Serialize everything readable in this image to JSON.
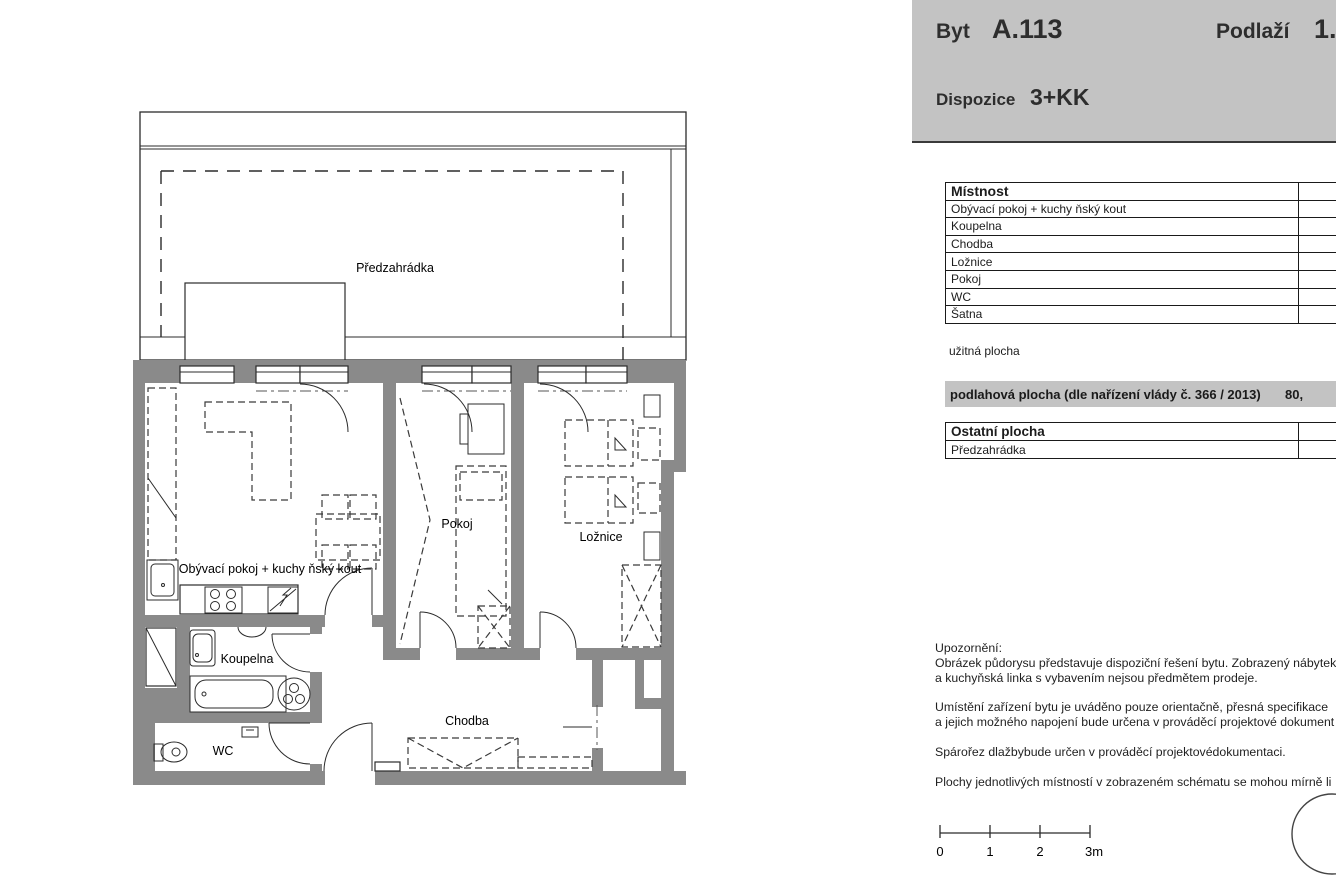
{
  "header": {
    "unit_label": "Byt",
    "unit_value": "A.113",
    "floor_label": "Podlaží",
    "floor_value": "1.",
    "layout_label": "Dispozice",
    "layout_value": "3+KK"
  },
  "rooms_table": {
    "title": "Místnost",
    "rows": [
      "Obývací pokoj + kuchy ňský kout",
      "Koupelna",
      "Chodba",
      "Ložnice",
      "Pokoj",
      "WC",
      "Šatna"
    ],
    "footnote": "užitná plocha"
  },
  "floor_area": {
    "label": "podlahová plocha (dle nařízení vlády č. 366 / 2013)",
    "value": "80,"
  },
  "other_area_table": {
    "title": "Ostatní plocha",
    "rows": [
      "Předzahrádka"
    ]
  },
  "notes": {
    "lines": [
      "Upozornění:",
      "Obrázek půdorysu představuje dispoziční řešení bytu. Zobrazený nábytek",
      "a kuchyňská linka s vybavením nejsou předmětem prodeje.",
      "Umístění zařízení bytu je uváděno pouze orientačně, přesná specifikace",
      "a jejich možného napojení bude určena v prováděcí projektové dokument",
      "Spárořez dlažbybude určen v prováděcí projektovédokumentaci.",
      "Plochy jednotlivých místností v zobrazeném schématu se mohou mírně li"
    ]
  },
  "scale_bar": {
    "labels": [
      "0",
      "1",
      "2",
      "3m"
    ]
  },
  "plan": {
    "labels": {
      "garden": "Předzahrádka",
      "living": "Obývací pokoj + kuchy ňský kout",
      "room": "Pokoj",
      "bedroom": "Ložnice",
      "bathroom": "Koupelna",
      "wc": "WC",
      "hall": "Chodba"
    }
  },
  "colors": {
    "wall_gray": "#8a8a8a",
    "panel_gray": "#c3c3c3",
    "line_dark": "#2b2b2b"
  }
}
